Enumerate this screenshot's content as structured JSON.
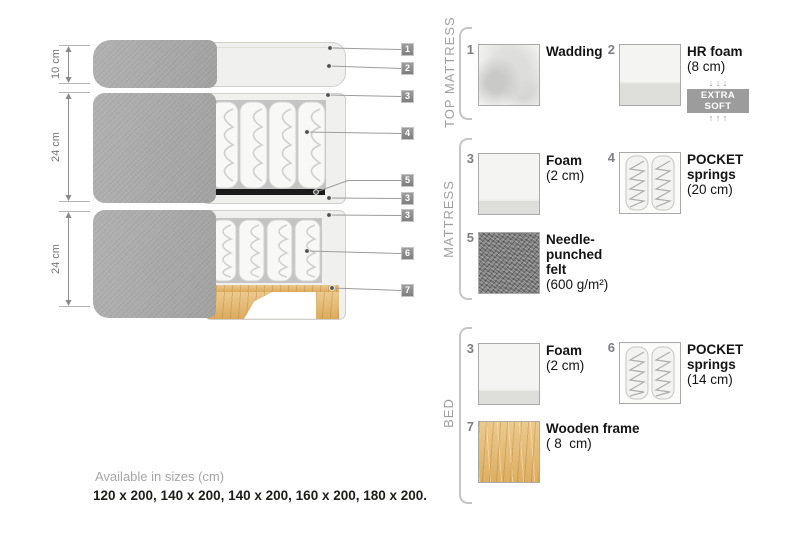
{
  "diagram": {
    "dimensions": [
      {
        "label": "10 cm"
      },
      {
        "label": "24 cm"
      },
      {
        "label": "24 cm"
      }
    ],
    "callouts": [
      {
        "label": "1"
      },
      {
        "label": "2"
      },
      {
        "label": "3"
      },
      {
        "label": "4"
      },
      {
        "label": "5"
      },
      {
        "label": "3"
      },
      {
        "label": "3"
      },
      {
        "label": "6"
      },
      {
        "label": "7"
      }
    ]
  },
  "legend": {
    "sections": [
      {
        "label": "TOP MATTRESS",
        "items": [
          {
            "num": "1",
            "name": "Wadding",
            "detail": ""
          },
          {
            "num": "2",
            "name": "HR foam",
            "detail": "(8 cm)",
            "arrows_down": "↓ ↓ ↓",
            "badge": "EXTRA SOFT",
            "arrows_up": "↑ ↑ ↑"
          }
        ]
      },
      {
        "label": "MATTRESS",
        "items": [
          {
            "num": "3",
            "name": "Foam",
            "detail": "(2 cm)"
          },
          {
            "num": "4",
            "name": "POCKET springs",
            "detail": "(20 cm)"
          },
          {
            "num": "5",
            "name": "Needle-punched felt",
            "detail": "(600 g/m²)"
          }
        ]
      },
      {
        "label": "BED",
        "items": [
          {
            "num": "3",
            "name": "Foam",
            "detail": "(2 cm)"
          },
          {
            "num": "6",
            "name": "POCKET springs",
            "detail": "(14 cm)"
          },
          {
            "num": "7",
            "name": "Wooden frame",
            "detail": "( 8  cm)"
          }
        ]
      }
    ]
  },
  "footer": {
    "title": "Available in sizes (cm)",
    "sizes": "120 x 200, 140 x 200, 140 x 200, 160 x 200, 180 x 200."
  },
  "colors": {
    "fabric_gray": "#a9a9a9",
    "interior_light": "#f0f0ee",
    "springs_bg": "#c4c4c4",
    "felt_bar": "#1a1a1a",
    "wood": "#e2b873",
    "badge_bg": "#9c9c9c",
    "label_gray": "#a0a0a0",
    "text_dark": "#141414"
  }
}
